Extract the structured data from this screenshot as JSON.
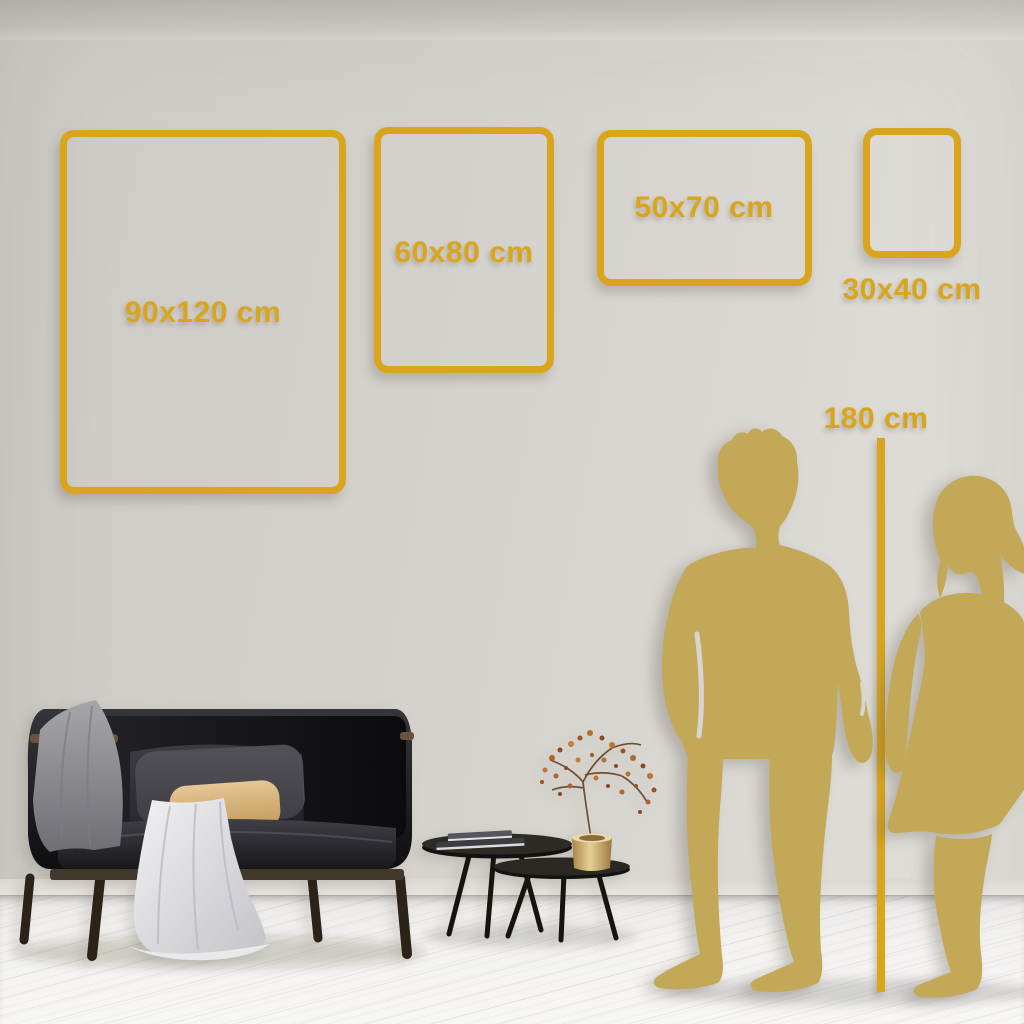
{
  "size_guide": {
    "frames": [
      {
        "label": "90x120 cm"
      },
      {
        "label": "60x80 cm"
      },
      {
        "label": "50x70 cm"
      },
      {
        "label": "30x40 cm"
      }
    ],
    "height_reference": {
      "label": "180 cm"
    }
  },
  "colors": {
    "accent_gold": "#D9A51C",
    "silhouette_gold": "#C2A857",
    "wall": "#D5D2CD",
    "floor": "#F3F2F0"
  },
  "scene_objects": {
    "figures": [
      "man-silhouette",
      "woman-silhouette"
    ],
    "furniture": [
      "sofa",
      "coffee-table-small",
      "coffee-table-large",
      "books-stack",
      "brass-vase",
      "dried-plant"
    ]
  }
}
